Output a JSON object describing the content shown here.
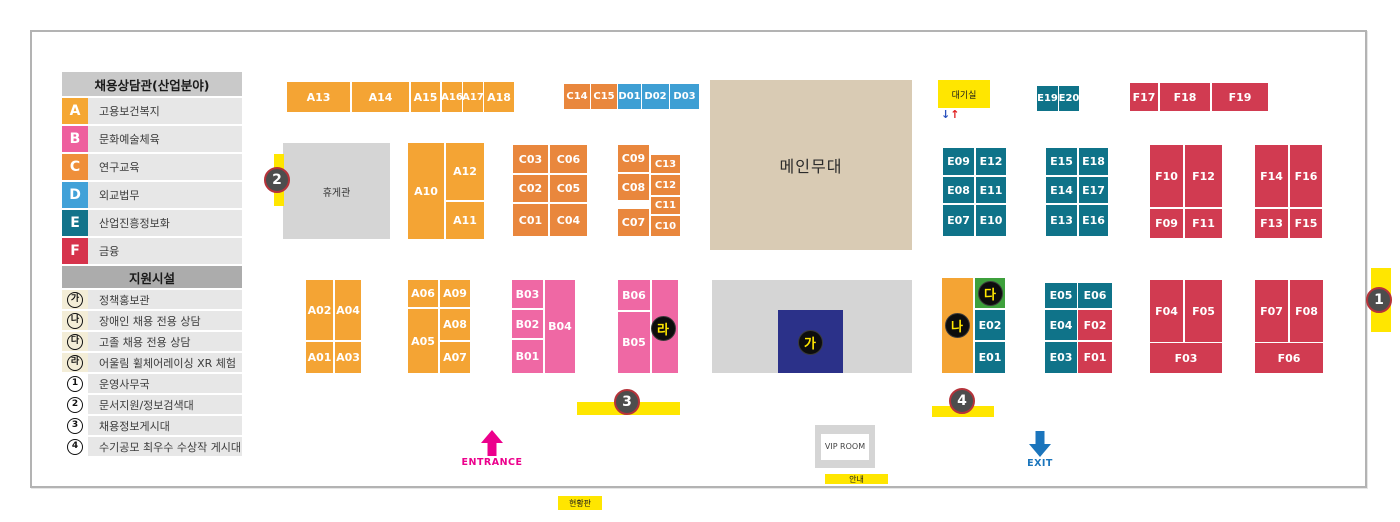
{
  "colors": {
    "A": "#f4a434",
    "B": "#ef68a4",
    "C": "#e9873d",
    "D": "#3e9fd4",
    "E": "#0f7389",
    "F": "#d13b51"
  },
  "legend": {
    "title": "채용상담관(산업분야)",
    "industries": [
      {
        "letter": "A",
        "label": "고용보건복지",
        "color": "#f5a733"
      },
      {
        "letter": "B",
        "label": "문화예술체육",
        "color": "#ee5f9e"
      },
      {
        "letter": "C",
        "label": "연구교육",
        "color": "#ef8f3a"
      },
      {
        "letter": "D",
        "label": "외교법무",
        "color": "#41a1d8"
      },
      {
        "letter": "E",
        "label": "산업진흥정보화",
        "color": "#12738a"
      },
      {
        "letter": "F",
        "label": "금융",
        "color": "#d6334c"
      }
    ],
    "facilities_title": "지원시설",
    "facilities": [
      {
        "symbol": "가",
        "type": "hangul",
        "label": "정책홍보관"
      },
      {
        "symbol": "나",
        "type": "hangul",
        "label": "장애인 채용 전용 상담"
      },
      {
        "symbol": "다",
        "type": "hangul",
        "label": "고졸 채용 전용 상담"
      },
      {
        "symbol": "라",
        "type": "hangul",
        "label": "어울림 휠체어레이싱 XR 체험"
      },
      {
        "symbol": "1",
        "type": "number",
        "label": "운영사무국"
      },
      {
        "symbol": "2",
        "type": "number",
        "label": "문서지원/정보검색대"
      },
      {
        "symbol": "3",
        "type": "number",
        "label": "채용정보게시대"
      },
      {
        "symbol": "4",
        "type": "number",
        "label": "수기공모 최우수 수상작 게시대"
      }
    ]
  },
  "floor": {
    "labels": {
      "rest_area": "휴게관",
      "main_stage": "메인무대",
      "waiting_room": "대기실",
      "vip_room": "VIP ROOM",
      "info": "안내",
      "status_board": "현황판",
      "entrance": "ENTRANCE",
      "exit": "EXIT",
      "arrow_down": "↓",
      "arrow_up": "↑"
    },
    "booths": [
      {
        "id": "A13",
        "c": "A",
        "x": 287,
        "y": 82,
        "w": 63,
        "h": 30
      },
      {
        "id": "A14",
        "c": "A",
        "x": 352,
        "y": 82,
        "w": 57,
        "h": 30
      },
      {
        "id": "A15",
        "c": "A",
        "x": 411,
        "y": 82,
        "w": 29,
        "h": 30
      },
      {
        "id": "A16",
        "c": "A",
        "x": 442,
        "y": 82,
        "w": 20,
        "h": 30,
        "fs": 10
      },
      {
        "id": "A17",
        "c": "A",
        "x": 463,
        "y": 82,
        "w": 20,
        "h": 30,
        "fs": 10
      },
      {
        "id": "A18",
        "c": "A",
        "x": 484,
        "y": 82,
        "w": 30,
        "h": 30
      },
      {
        "id": "C14",
        "c": "C",
        "x": 564,
        "y": 84,
        "w": 26,
        "h": 25,
        "fs": 10
      },
      {
        "id": "C15",
        "c": "C",
        "x": 591,
        "y": 84,
        "w": 26,
        "h": 25,
        "fs": 10
      },
      {
        "id": "D01",
        "c": "D",
        "x": 618,
        "y": 84,
        "w": 23,
        "h": 25,
        "fs": 10
      },
      {
        "id": "D02",
        "c": "D",
        "x": 642,
        "y": 84,
        "w": 27,
        "h": 25,
        "fs": 10
      },
      {
        "id": "D03",
        "c": "D",
        "x": 670,
        "y": 84,
        "w": 29,
        "h": 25,
        "fs": 10
      },
      {
        "id": "A10",
        "c": "A",
        "x": 408,
        "y": 143,
        "w": 36,
        "h": 96
      },
      {
        "id": "A12",
        "c": "A",
        "x": 446,
        "y": 143,
        "w": 38,
        "h": 57
      },
      {
        "id": "A11",
        "c": "A",
        "x": 446,
        "y": 202,
        "w": 38,
        "h": 37
      },
      {
        "id": "C03",
        "c": "C",
        "x": 513,
        "y": 145,
        "w": 35,
        "h": 28
      },
      {
        "id": "C06",
        "c": "C",
        "x": 550,
        "y": 145,
        "w": 37,
        "h": 28
      },
      {
        "id": "C02",
        "c": "C",
        "x": 513,
        "y": 175,
        "w": 35,
        "h": 27
      },
      {
        "id": "C05",
        "c": "C",
        "x": 550,
        "y": 175,
        "w": 37,
        "h": 27
      },
      {
        "id": "C01",
        "c": "C",
        "x": 513,
        "y": 204,
        "w": 35,
        "h": 32
      },
      {
        "id": "C04",
        "c": "C",
        "x": 550,
        "y": 204,
        "w": 37,
        "h": 32
      },
      {
        "id": "C09",
        "c": "C",
        "x": 618,
        "y": 145,
        "w": 31,
        "h": 27
      },
      {
        "id": "C08",
        "c": "C",
        "x": 618,
        "y": 174,
        "w": 31,
        "h": 26
      },
      {
        "id": "C07",
        "c": "C",
        "x": 618,
        "y": 209,
        "w": 31,
        "h": 27
      },
      {
        "id": "C13",
        "c": "C",
        "x": 651,
        "y": 155,
        "w": 29,
        "h": 18,
        "fs": 10
      },
      {
        "id": "C12",
        "c": "C",
        "x": 651,
        "y": 175,
        "w": 29,
        "h": 20,
        "fs": 10
      },
      {
        "id": "C11",
        "c": "C",
        "x": 651,
        "y": 197,
        "w": 29,
        "h": 17,
        "fs": 10
      },
      {
        "id": "C10",
        "c": "C",
        "x": 651,
        "y": 216,
        "w": 29,
        "h": 20,
        "fs": 10
      },
      {
        "id": "E19",
        "c": "E",
        "x": 1037,
        "y": 86,
        "w": 21,
        "h": 25,
        "fs": 10
      },
      {
        "id": "E20",
        "c": "E",
        "x": 1059,
        "y": 86,
        "w": 20,
        "h": 25,
        "fs": 10
      },
      {
        "id": "E09",
        "c": "E",
        "x": 943,
        "y": 148,
        "w": 31,
        "h": 27
      },
      {
        "id": "E12",
        "c": "E",
        "x": 976,
        "y": 148,
        "w": 30,
        "h": 27
      },
      {
        "id": "E08",
        "c": "E",
        "x": 943,
        "y": 177,
        "w": 31,
        "h": 26
      },
      {
        "id": "E11",
        "c": "E",
        "x": 976,
        "y": 177,
        "w": 30,
        "h": 26
      },
      {
        "id": "E07",
        "c": "E",
        "x": 943,
        "y": 205,
        "w": 31,
        "h": 31
      },
      {
        "id": "E10",
        "c": "E",
        "x": 976,
        "y": 205,
        "w": 30,
        "h": 31
      },
      {
        "id": "E15",
        "c": "E",
        "x": 1046,
        "y": 148,
        "w": 31,
        "h": 27
      },
      {
        "id": "E18",
        "c": "E",
        "x": 1079,
        "y": 148,
        "w": 29,
        "h": 27
      },
      {
        "id": "E14",
        "c": "E",
        "x": 1046,
        "y": 177,
        "w": 31,
        "h": 26
      },
      {
        "id": "E17",
        "c": "E",
        "x": 1079,
        "y": 177,
        "w": 29,
        "h": 26
      },
      {
        "id": "E13",
        "c": "E",
        "x": 1046,
        "y": 205,
        "w": 31,
        "h": 31
      },
      {
        "id": "E16",
        "c": "E",
        "x": 1079,
        "y": 205,
        "w": 29,
        "h": 31
      },
      {
        "id": "F17",
        "c": "F",
        "x": 1130,
        "y": 83,
        "w": 28,
        "h": 28
      },
      {
        "id": "F18",
        "c": "F",
        "x": 1160,
        "y": 83,
        "w": 50,
        "h": 28
      },
      {
        "id": "F19",
        "c": "F",
        "x": 1212,
        "y": 83,
        "w": 56,
        "h": 28
      },
      {
        "id": "F10",
        "c": "F",
        "x": 1150,
        "y": 145,
        "w": 33,
        "h": 62
      },
      {
        "id": "F12",
        "c": "F",
        "x": 1185,
        "y": 145,
        "w": 37,
        "h": 62
      },
      {
        "id": "F09",
        "c": "F",
        "x": 1150,
        "y": 209,
        "w": 33,
        "h": 29
      },
      {
        "id": "F11",
        "c": "F",
        "x": 1185,
        "y": 209,
        "w": 37,
        "h": 29
      },
      {
        "id": "F14",
        "c": "F",
        "x": 1255,
        "y": 145,
        "w": 33,
        "h": 62
      },
      {
        "id": "F16",
        "c": "F",
        "x": 1290,
        "y": 145,
        "w": 32,
        "h": 62
      },
      {
        "id": "F13",
        "c": "F",
        "x": 1255,
        "y": 209,
        "w": 33,
        "h": 29
      },
      {
        "id": "F15",
        "c": "F",
        "x": 1290,
        "y": 209,
        "w": 32,
        "h": 29
      },
      {
        "id": "A02",
        "c": "A",
        "x": 306,
        "y": 280,
        "w": 27,
        "h": 60
      },
      {
        "id": "A04",
        "c": "A",
        "x": 335,
        "y": 280,
        "w": 26,
        "h": 60
      },
      {
        "id": "A01",
        "c": "A",
        "x": 306,
        "y": 342,
        "w": 27,
        "h": 31
      },
      {
        "id": "A03",
        "c": "A",
        "x": 335,
        "y": 342,
        "w": 26,
        "h": 31
      },
      {
        "id": "A06",
        "c": "A",
        "x": 408,
        "y": 280,
        "w": 30,
        "h": 27
      },
      {
        "id": "A09",
        "c": "A",
        "x": 440,
        "y": 280,
        "w": 30,
        "h": 27
      },
      {
        "id": "A05",
        "c": "A",
        "x": 408,
        "y": 309,
        "w": 30,
        "h": 64
      },
      {
        "id": "A08",
        "c": "A",
        "x": 440,
        "y": 309,
        "w": 30,
        "h": 31
      },
      {
        "id": "A07",
        "c": "A",
        "x": 440,
        "y": 342,
        "w": 30,
        "h": 31
      },
      {
        "id": "B03",
        "c": "B",
        "x": 512,
        "y": 280,
        "w": 31,
        "h": 28
      },
      {
        "id": "B02",
        "c": "B",
        "x": 512,
        "y": 310,
        "w": 31,
        "h": 28
      },
      {
        "id": "B01",
        "c": "B",
        "x": 512,
        "y": 340,
        "w": 31,
        "h": 33
      },
      {
        "id": "B04",
        "c": "B",
        "x": 545,
        "y": 280,
        "w": 30,
        "h": 93
      },
      {
        "id": "B06",
        "c": "B",
        "x": 618,
        "y": 280,
        "w": 32,
        "h": 30
      },
      {
        "id": "B05",
        "c": "B",
        "x": 618,
        "y": 312,
        "w": 32,
        "h": 61
      },
      {
        "id": "",
        "name": "booth-b-annex",
        "c": "B",
        "x": 652,
        "y": 280,
        "w": 26,
        "h": 93
      },
      {
        "id": "",
        "name": "booth-na-zone",
        "c": "A",
        "x": 942,
        "y": 278,
        "w": 31,
        "h": 95
      },
      {
        "id": "",
        "name": "booth-da-zone",
        "c": "#3ea03c",
        "x": 975,
        "y": 278,
        "w": 30,
        "h": 30
      },
      {
        "id": "E02",
        "c": "E",
        "x": 975,
        "y": 310,
        "w": 30,
        "h": 30
      },
      {
        "id": "E01",
        "c": "E",
        "x": 975,
        "y": 342,
        "w": 30,
        "h": 31
      },
      {
        "id": "E05",
        "c": "E",
        "x": 1045,
        "y": 283,
        "w": 32,
        "h": 25
      },
      {
        "id": "E06",
        "c": "E",
        "x": 1078,
        "y": 283,
        "w": 34,
        "h": 25
      },
      {
        "id": "E04",
        "c": "E",
        "x": 1045,
        "y": 310,
        "w": 32,
        "h": 30
      },
      {
        "id": "F02",
        "c": "F",
        "x": 1078,
        "y": 310,
        "w": 34,
        "h": 30
      },
      {
        "id": "E03",
        "c": "E",
        "x": 1045,
        "y": 342,
        "w": 32,
        "h": 31
      },
      {
        "id": "F01",
        "c": "F",
        "x": 1078,
        "y": 342,
        "w": 34,
        "h": 31
      },
      {
        "id": "F04",
        "c": "F",
        "x": 1150,
        "y": 280,
        "w": 33,
        "h": 62
      },
      {
        "id": "F05",
        "c": "F",
        "x": 1185,
        "y": 280,
        "w": 37,
        "h": 62
      },
      {
        "id": "F03",
        "c": "F",
        "x": 1150,
        "y": 343,
        "w": 72,
        "h": 30
      },
      {
        "id": "F07",
        "c": "F",
        "x": 1255,
        "y": 280,
        "w": 33,
        "h": 62
      },
      {
        "id": "F08",
        "c": "F",
        "x": 1290,
        "y": 280,
        "w": 33,
        "h": 62
      },
      {
        "id": "F06",
        "c": "F",
        "x": 1255,
        "y": 343,
        "w": 68,
        "h": 30
      }
    ],
    "number_markers": [
      {
        "number": "1",
        "cx": 1379,
        "cy": 300,
        "strip": {
          "x": 1371,
          "y": 268,
          "w": 20,
          "h": 64
        }
      },
      {
        "number": "2",
        "cx": 277,
        "cy": 180,
        "strip": {
          "x": 274,
          "y": 154,
          "w": 10,
          "h": 52
        }
      },
      {
        "number": "3",
        "cx": 627,
        "cy": 402,
        "strip": {
          "x": 577,
          "y": 402,
          "w": 103,
          "h": 13
        }
      },
      {
        "number": "4",
        "cx": 962,
        "cy": 401,
        "strip": {
          "x": 932,
          "y": 406,
          "w": 62,
          "h": 11
        }
      }
    ],
    "hangul_markers": [
      {
        "char": "가",
        "cx": 810,
        "cy": 342
      },
      {
        "char": "나",
        "cx": 957,
        "cy": 325
      },
      {
        "char": "다",
        "cx": 990,
        "cy": 293
      },
      {
        "char": "라",
        "cx": 663,
        "cy": 328
      }
    ]
  }
}
